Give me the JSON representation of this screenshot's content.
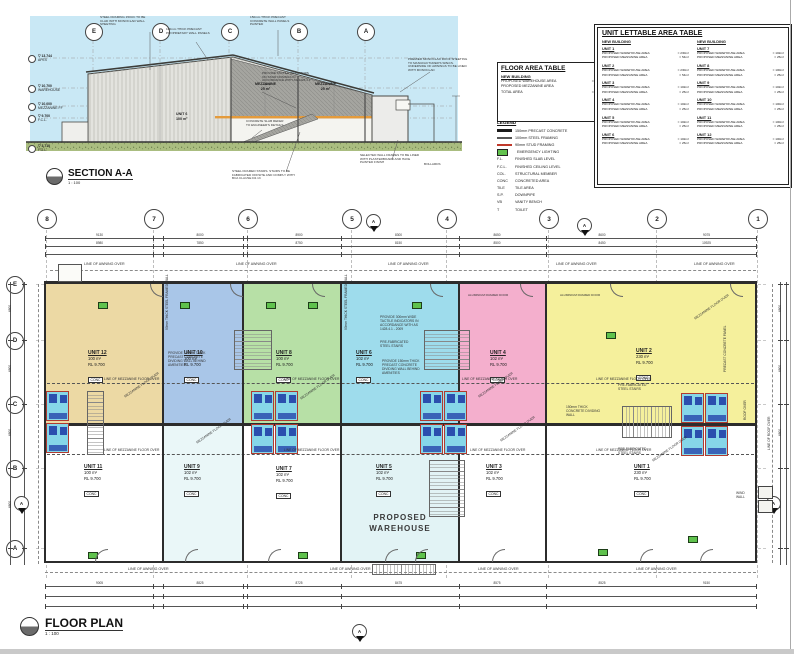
{
  "section": {
    "title": "SECTION A-A",
    "scale": "1 : 100",
    "grid_letters": [
      "E",
      "D",
      "C",
      "B",
      "A"
    ],
    "levels": [
      {
        "rl": "13.744",
        "label": "APEX"
      },
      {
        "rl": "10.700",
        "label": "WAREHOUSE"
      },
      {
        "rl": "10.000",
        "label": "MEZZANINE FF"
      },
      {
        "rl": "9.700",
        "label": "F.C.L."
      },
      {
        "rl": "3.710",
        "label": "F.G.L."
      }
    ],
    "room_labels": [
      {
        "t": "MEZZANINE",
        "t2": "25 m²",
        "x": 255,
        "y": 82
      },
      {
        "t": "MEZZANINE",
        "t2": "25 m²",
        "x": 315,
        "y": 82
      },
      {
        "t": "UNIT 6",
        "t2": "100 m²",
        "x": 176,
        "y": 112
      }
    ],
    "notes": [
      {
        "t": "STEEL FRAMING 150UC TO BE CLAD WITH MONOCLAD WALL SHEETING",
        "x": 100,
        "y": 16,
        "w": 52
      },
      {
        "t": "100mm THICK PRECAST PROPRIETARY WALL PANELS",
        "x": 166,
        "y": 28,
        "w": 46
      },
      {
        "t": "150mm THICK PRECAST CONCRETE WALL PANELS PAINTED",
        "x": 250,
        "y": 16,
        "w": 50
      },
      {
        "t": "PROVIDE TACTILE INDICATORS ON STAIR NOSINGS IN ACCORDANCE WITH AS 1428.4.1 - 2009",
        "x": 262,
        "y": 72,
        "w": 50
      },
      {
        "t": "PREMIER MONOCLAD ROOF SHEETING TO MANUFACTURER'S SPECS. UNDERSIDE OF AWNINGS TO BE LINED WITH MONOCLAD",
        "x": 408,
        "y": 58,
        "w": 60
      },
      {
        "t": "CONCRETE SLAB REFER TO ENGINEER'S DETAILS",
        "x": 246,
        "y": 120,
        "w": 42
      },
      {
        "t": "STEEL FRAMED STAIRS. STAIRS TO BE FABRICATED OFFSITE AND COMPLY WITH BCA CLAUSE D2.13",
        "x": 232,
        "y": 170,
        "w": 64
      },
      {
        "t": "SELECTED WALL FRAMES TO BE LINED WITH PLASTERBOARD AND HAVE PAINTED FINISH",
        "x": 360,
        "y": 154,
        "w": 60
      },
      {
        "t": "BOLLARDS",
        "x": 424,
        "y": 163,
        "w": 30
      }
    ]
  },
  "floor_area_table": {
    "title": "FLOOR AREA TABLE",
    "subtitle": "NEW BUILDING",
    "rows": [
      {
        "label": "PROPOSED WAREHOUSE AREA",
        "value": "1500m²"
      },
      {
        "label": "PROPOSED MEZZANINE AREA",
        "value": "300m²"
      },
      {
        "label": "TOTAL AREA",
        "value": "1800m²"
      }
    ]
  },
  "legend": {
    "title": "LEGEND",
    "items": [
      {
        "swatch": "precast",
        "abbr": "",
        "label": "150mm PRECAST CONCRETE"
      },
      {
        "swatch": "steel",
        "abbr": "",
        "label": "100mm STEEL FRAMING"
      },
      {
        "swatch": "stud",
        "abbr": "",
        "label": "90mm STUD FRAMING"
      },
      {
        "swatch": "emergency",
        "abbr": "",
        "label": "EMERGENCY LIGHTING"
      },
      {
        "swatch": "",
        "abbr": "F.L.",
        "label": "FINISHED SLAB LEVEL"
      },
      {
        "swatch": "",
        "abbr": "F.C.L.",
        "label": "FINISHED CEILING LEVEL"
      },
      {
        "swatch": "",
        "abbr": "COL.",
        "label": "STRUCTURAL MEMBER"
      },
      {
        "swatch": "",
        "abbr": "CONC",
        "label": "CONCRETED AREA"
      },
      {
        "swatch": "",
        "abbr": "TILE",
        "label": "TILE AREA"
      },
      {
        "swatch": "",
        "abbr": "S.P.",
        "label": "DOWNPIPE"
      },
      {
        "swatch": "",
        "abbr": "VB",
        "label": "VANITY BENCH"
      },
      {
        "swatch": "",
        "abbr": "T",
        "label": "TOILET"
      }
    ]
  },
  "unit_table": {
    "title": "UNIT LETTABLE AREA TABLE",
    "col_headers": [
      "NEW BUILDING",
      "NEW BUILDING"
    ],
    "warehouse_label": "PROPOSED WAREHOUSE AREA",
    "mezzanine_label": "PROPOSED MEZZANINE AREA",
    "units": [
      {
        "name": "UNIT 1",
        "warehouse": "230m²",
        "mezzanine": "54m²"
      },
      {
        "name": "UNIT 2",
        "warehouse": "230m²",
        "mezzanine": "54m²"
      },
      {
        "name": "UNIT 3",
        "warehouse": "102m²",
        "mezzanine": "25m²"
      },
      {
        "name": "UNIT 4",
        "warehouse": "102m²",
        "mezzanine": "25m²"
      },
      {
        "name": "UNIT 5",
        "warehouse": "102m²",
        "mezzanine": "25m²"
      },
      {
        "name": "UNIT 6",
        "warehouse": "102m²",
        "mezzanine": "25m²"
      },
      {
        "name": "UNIT 7",
        "warehouse": "102m²",
        "mezzanine": "25m²"
      },
      {
        "name": "UNIT 8",
        "warehouse": "100m²",
        "mezzanine": "25m²"
      },
      {
        "name": "UNIT 9",
        "warehouse": "102m²",
        "mezzanine": "25m²"
      },
      {
        "name": "UNIT 10",
        "warehouse": "100m²",
        "mezzanine": "25m²"
      },
      {
        "name": "UNIT 11",
        "warehouse": "100m²",
        "mezzanine": "25m²"
      },
      {
        "name": "UNIT 12",
        "warehouse": "100m²",
        "mezzanine": "25m²"
      }
    ]
  },
  "plan": {
    "title": "FLOOR PLAN",
    "scale": "1 : 100",
    "big_label": "PROPOSED WAREHOUSE",
    "grid_cols": [
      "8",
      "7",
      "6",
      "5",
      "4",
      "3",
      "2",
      "1"
    ],
    "grid_rows": [
      "E",
      "D",
      "C",
      "B",
      "A"
    ],
    "units": [
      {
        "name": "UNIT 12",
        "area": "100 m²",
        "rl": "RL 9.700",
        "tag": "CONC",
        "color": "#ecd9a4",
        "x": 45,
        "y": 284,
        "w": 118,
        "h": 139,
        "lx": 88,
        "ly": 350
      },
      {
        "name": "UNIT 10",
        "area": "100 m²",
        "rl": "RL 9.700",
        "tag": "CONC",
        "color": "#a9c6e8",
        "x": 163,
        "y": 284,
        "w": 80,
        "h": 139,
        "lx": 184,
        "ly": 350
      },
      {
        "name": "UNIT 8",
        "area": "100 m²",
        "rl": "RL 9.700",
        "tag": "CONC",
        "color": "#b7e0a6",
        "x": 243,
        "y": 284,
        "w": 98,
        "h": 139,
        "lx": 276,
        "ly": 350
      },
      {
        "name": "UNIT 6",
        "area": "102 m²",
        "rl": "RL 9.700",
        "tag": "CONC",
        "color": "#9edcec",
        "x": 341,
        "y": 284,
        "w": 118,
        "h": 139,
        "lx": 356,
        "ly": 350
      },
      {
        "name": "UNIT 4",
        "area": "102 m²",
        "rl": "RL 9.700",
        "tag": "CONC",
        "color": "#f4afcd",
        "x": 459,
        "y": 284,
        "w": 87,
        "h": 139,
        "lx": 490,
        "ly": 350
      },
      {
        "name": "UNIT 2",
        "area": "230 m²",
        "rl": "RL 9.700",
        "tag": "CONC",
        "color": "#f5f09c",
        "x": 546,
        "y": 284,
        "w": 210,
        "h": 139,
        "lx": 636,
        "ly": 348
      },
      {
        "name": "UNIT 11",
        "area": "100 m²",
        "rl": "RL 9.700",
        "tag": "CONC",
        "color": "#ffffff",
        "x": 45,
        "y": 426,
        "w": 118,
        "h": 137,
        "lx": 84,
        "ly": 464
      },
      {
        "name": "UNIT 9",
        "area": "102 m²",
        "rl": "RL 9.700",
        "tag": "CONC",
        "color": "#eaf7f8",
        "x": 163,
        "y": 426,
        "w": 80,
        "h": 137,
        "lx": 184,
        "ly": 464
      },
      {
        "name": "UNIT 7",
        "area": "102 m²",
        "rl": "RL 9.700",
        "tag": "CONC",
        "color": "#ffffff",
        "x": 243,
        "y": 426,
        "w": 98,
        "h": 137,
        "lx": 276,
        "ly": 466
      },
      {
        "name": "UNIT 5",
        "area": "102 m²",
        "rl": "RL 9.700",
        "tag": "CONC",
        "color": "#e2f3f5",
        "x": 341,
        "y": 426,
        "w": 118,
        "h": 137,
        "lx": 376,
        "ly": 464
      },
      {
        "name": "UNIT 3",
        "area": "102 m²",
        "rl": "RL 9.700",
        "tag": "CONC",
        "color": "#ffffff",
        "x": 459,
        "y": 426,
        "w": 87,
        "h": 137,
        "lx": 486,
        "ly": 464
      },
      {
        "name": "UNIT 1",
        "area": "230 m²",
        "rl": "RL 9.700",
        "tag": "CONC",
        "color": "#ffffff",
        "x": 546,
        "y": 426,
        "w": 210,
        "h": 137,
        "lx": 634,
        "ly": 464
      }
    ],
    "notes": [
      {
        "t": "LINE OF AWNING OVER",
        "x": 84,
        "y": 262,
        "s": 3.6
      },
      {
        "t": "LINE OF AWNING OVER",
        "x": 236,
        "y": 262,
        "s": 3.6
      },
      {
        "t": "LINE OF AWNING OVER",
        "x": 388,
        "y": 262,
        "s": 3.6
      },
      {
        "t": "LINE OF AWNING OVER",
        "x": 556,
        "y": 262,
        "s": 3.6
      },
      {
        "t": "LINE OF AWNING OVER",
        "x": 694,
        "y": 262,
        "s": 3.6
      },
      {
        "t": "LINE OF AWNING OVER",
        "x": 128,
        "y": 567,
        "s": 3.6
      },
      {
        "t": "LINE OF AWNING OVER",
        "x": 330,
        "y": 567,
        "s": 3.6
      },
      {
        "t": "LINE OF AWNING OVER",
        "x": 478,
        "y": 567,
        "s": 3.6
      },
      {
        "t": "LINE OF AWNING OVER",
        "x": 636,
        "y": 567,
        "s": 3.6
      },
      {
        "t": "LINE OF MEZZANINE FLOOR OVER",
        "x": 104,
        "y": 378,
        "s": 3.3
      },
      {
        "t": "LINE OF MEZZANINE FLOOR OVER",
        "x": 284,
        "y": 378,
        "s": 3.3
      },
      {
        "t": "LINE OF MEZZANINE FLOOR OVER",
        "x": 462,
        "y": 378,
        "s": 3.3
      },
      {
        "t": "LINE OF MEZZANINE FLOOR OVER",
        "x": 596,
        "y": 378,
        "s": 3.3
      },
      {
        "t": "LINE OF MEZZANINE FLOOR OVER",
        "x": 104,
        "y": 449,
        "s": 3.3
      },
      {
        "t": "LINE OF MEZZANINE FLOOR OVER",
        "x": 284,
        "y": 449,
        "s": 3.3
      },
      {
        "t": "LINE OF MEZZANINE FLOOR OVER",
        "x": 470,
        "y": 449,
        "s": 3.3
      },
      {
        "t": "LINE OF MEZZANINE FLOOR OVER",
        "x": 596,
        "y": 449,
        "s": 3.3
      },
      {
        "t": "MEZZANINE FLOOR OVER",
        "x": 124,
        "y": 396,
        "r": -35,
        "s": 3.3
      },
      {
        "t": "MEZZANINE FLOOR OVER",
        "x": 300,
        "y": 398,
        "r": -35,
        "s": 3.3
      },
      {
        "t": "MEZZANINE FLOOR OVER",
        "x": 478,
        "y": 396,
        "r": -35,
        "s": 3.3
      },
      {
        "t": "MEZZANINE FLOOR OVER",
        "x": 694,
        "y": 318,
        "r": -35,
        "s": 3.3
      },
      {
        "t": "MEZZANINE FLOOR OVER",
        "x": 196,
        "y": 442,
        "r": -35,
        "s": 3.3
      },
      {
        "t": "MEZZANINE FLOOR OVER",
        "x": 500,
        "y": 440,
        "r": -35,
        "s": 3.3
      },
      {
        "t": "MEZZANINE FLOOR OVER",
        "x": 652,
        "y": 460,
        "r": -35,
        "s": 3.3
      },
      {
        "t": "PROVIDE 150mm THICK PRECAST CONCRETE DIVIDING WALL BEHIND AMENITIES",
        "x": 168,
        "y": 352,
        "w": 42,
        "s": 3.3
      },
      {
        "t": "PROVIDE 150mm THICK PRECAST CONCRETE DIVIDING WALL BEHIND AMENITIES",
        "x": 382,
        "y": 360,
        "w": 42,
        "s": 3.3
      },
      {
        "t": "PROVIDE 300mm WIDE TACTILE INDICATORS IN ACCORDANCE WITH AS 1428.4.1 - 2009",
        "x": 380,
        "y": 316,
        "w": 46,
        "s": 3.3
      },
      {
        "t": "PRE-FABRICATED STEEL STAIRS",
        "x": 380,
        "y": 341,
        "w": 34,
        "s": 3.3
      },
      {
        "t": "PRE-FABRICATED STEEL STAIRS",
        "x": 618,
        "y": 384,
        "w": 34,
        "s": 3.3
      },
      {
        "t": "PRE-FABRICATED STEEL STAIRS",
        "x": 618,
        "y": 448,
        "w": 34,
        "s": 3.3
      },
      {
        "t": "150mm THICK CONCRETE DIVIDING WALL",
        "x": 566,
        "y": 406,
        "w": 40,
        "s": 3.3
      },
      {
        "t": "90mm THICK STEEL FRAMED WALL",
        "x": 166,
        "y": 330,
        "r": -90,
        "s": 3.3
      },
      {
        "t": "90mm THICK STEEL FRAMED WALL",
        "x": 345,
        "y": 330,
        "r": -90,
        "s": 3.3
      },
      {
        "t": "WIND WALL",
        "x": 736,
        "y": 492,
        "w": 18,
        "s": 3.3
      },
      {
        "t": "ROOF OVER",
        "x": 744,
        "y": 420,
        "r": -90,
        "s": 3.3
      },
      {
        "t": "LINE OF ROOF OVER",
        "x": 768,
        "y": 450,
        "r": -90,
        "s": 3.3
      },
      {
        "t": "PRECAST CONCRETE PANEL",
        "x": 724,
        "y": 372,
        "r": -90,
        "s": 3.3
      },
      {
        "t": "ALUMINIUM FRAMED DOOR",
        "x": 468,
        "y": 294,
        "s": 3
      },
      {
        "t": "ALUMINIUM FRAMED DOOR",
        "x": 560,
        "y": 294,
        "s": 3
      }
    ],
    "dims_top": [
      "9130",
      "8000",
      "8900",
      "8300",
      "8650",
      "8600",
      "9075"
    ],
    "dims_top2": [
      "8980",
      "7850",
      "8750",
      "8150",
      "8500",
      "8450",
      "10925"
    ],
    "dims_bottom": [
      "9005",
      "8825",
      "8725",
      "8475",
      "8575",
      "8525",
      "9150"
    ],
    "dims_left": [
      "6800",
      "6800",
      "6800",
      "6800"
    ],
    "dims_right": [
      "6800",
      "6800",
      "6800",
      "6800"
    ]
  }
}
